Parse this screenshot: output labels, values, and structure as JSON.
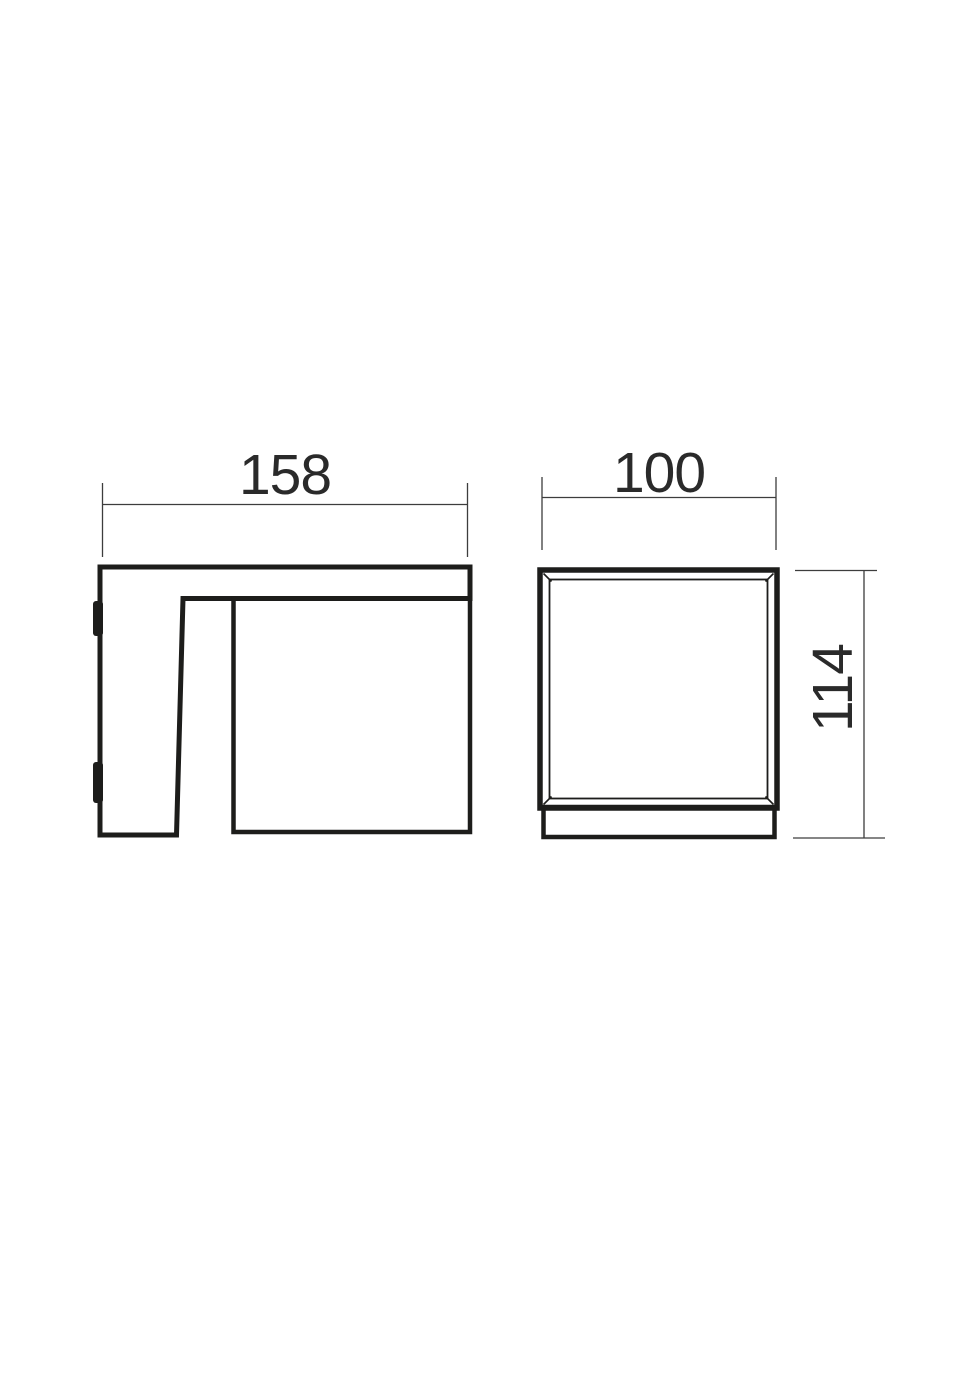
{
  "drawing": {
    "type": "technical-dimension-drawing",
    "side_view": {
      "width_label": "158"
    },
    "front_view": {
      "width_label": "100",
      "height_label": "114"
    }
  },
  "colors": {
    "background": "#ffffff",
    "outline": "#1d1d1b",
    "dimension_line": "#3d3d3d",
    "text": "#2a2a2a"
  }
}
